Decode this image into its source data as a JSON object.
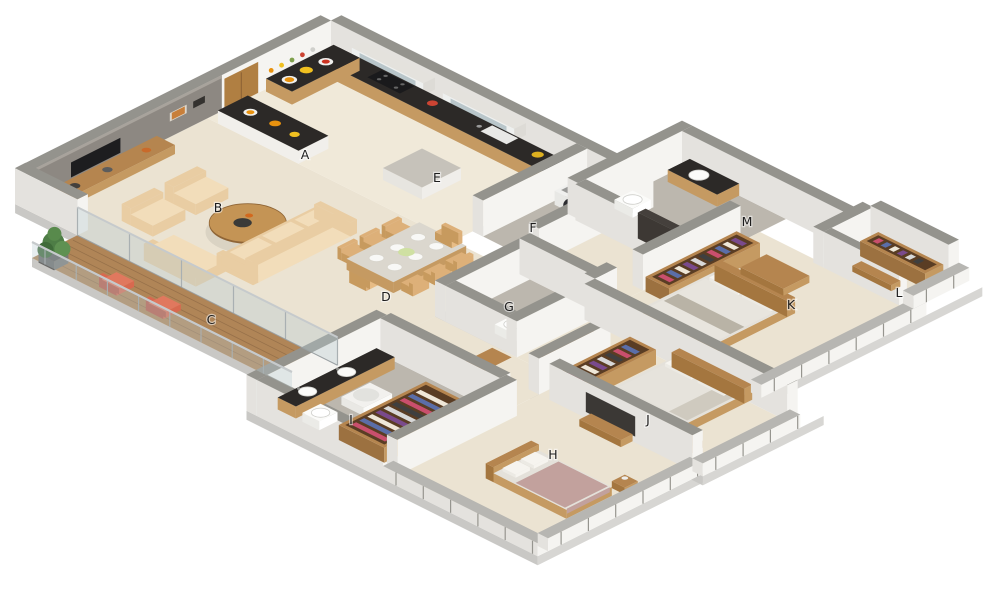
{
  "canvas": {
    "width": 1000,
    "height": 600,
    "background": "#ffffff",
    "kind": "isometric-3d-floor-plan"
  },
  "rooms": [
    {
      "label": "A",
      "name": "breakfast-counter",
      "x": 305,
      "y": 155
    },
    {
      "label": "B",
      "name": "living-room",
      "x": 218,
      "y": 208
    },
    {
      "label": "C",
      "name": "balcony-deck",
      "x": 211,
      "y": 320
    },
    {
      "label": "D",
      "name": "dining-area",
      "x": 386,
      "y": 297
    },
    {
      "label": "E",
      "name": "kitchen",
      "x": 437,
      "y": 178
    },
    {
      "label": "F",
      "name": "utility-laundry",
      "x": 533,
      "y": 228
    },
    {
      "label": "G",
      "name": "toilet",
      "x": 509,
      "y": 307
    },
    {
      "label": "H",
      "name": "bedroom-3",
      "x": 553,
      "y": 455
    },
    {
      "label": "I",
      "name": "bathroom-dressing",
      "x": 351,
      "y": 420
    },
    {
      "label": "J",
      "name": "bedroom-2",
      "x": 648,
      "y": 420
    },
    {
      "label": "K",
      "name": "master-bedroom",
      "x": 791,
      "y": 305
    },
    {
      "label": "L",
      "name": "dressing-room",
      "x": 899,
      "y": 293
    },
    {
      "label": "M",
      "name": "master-bathroom",
      "x": 747,
      "y": 222
    }
  ],
  "palette": {
    "wallFace": "#f5f4f1",
    "wallSide": "#e4e2de",
    "wallTop": "#94938d",
    "slabSE": "#d7d6d3",
    "slabSW": "#c9c8c5",
    "floorCream": "#ebe3d2",
    "floorCream2": "#f0e9d9",
    "tile": "#bcb7ae",
    "deck": "#b08557",
    "deckLine": "#97714a",
    "grayWall": "#8d8882",
    "tv": "#1d1d1f",
    "counterDark": "#2c2927",
    "cabinetWood": "#c59а62",
    "wood": "#b5854f",
    "woodDark": "#8f6536",
    "glass": "#b9c6ca",
    "sofa": "#e9cda3",
    "sofaLight": "#f2ddba",
    "tableWood": "#c49455",
    "chairTan": "#ddb079",
    "red": "#d8before",
    "plant": "#4e7d46",
    "island": "#c6c2ba",
    "bedWhite": "#e4e1da",
    "bedMauve": "#c2a19d",
    "pillow": "#f6f4ef",
    "darkPanel": "#45403c",
    "basin": "#fbfbf9",
    "clothes": [
      "#c94f6d",
      "#5b6ea8",
      "#efe7d8",
      "#7a4a8c",
      "#d8d8d8",
      "#3f3f3f"
    ]
  }
}
